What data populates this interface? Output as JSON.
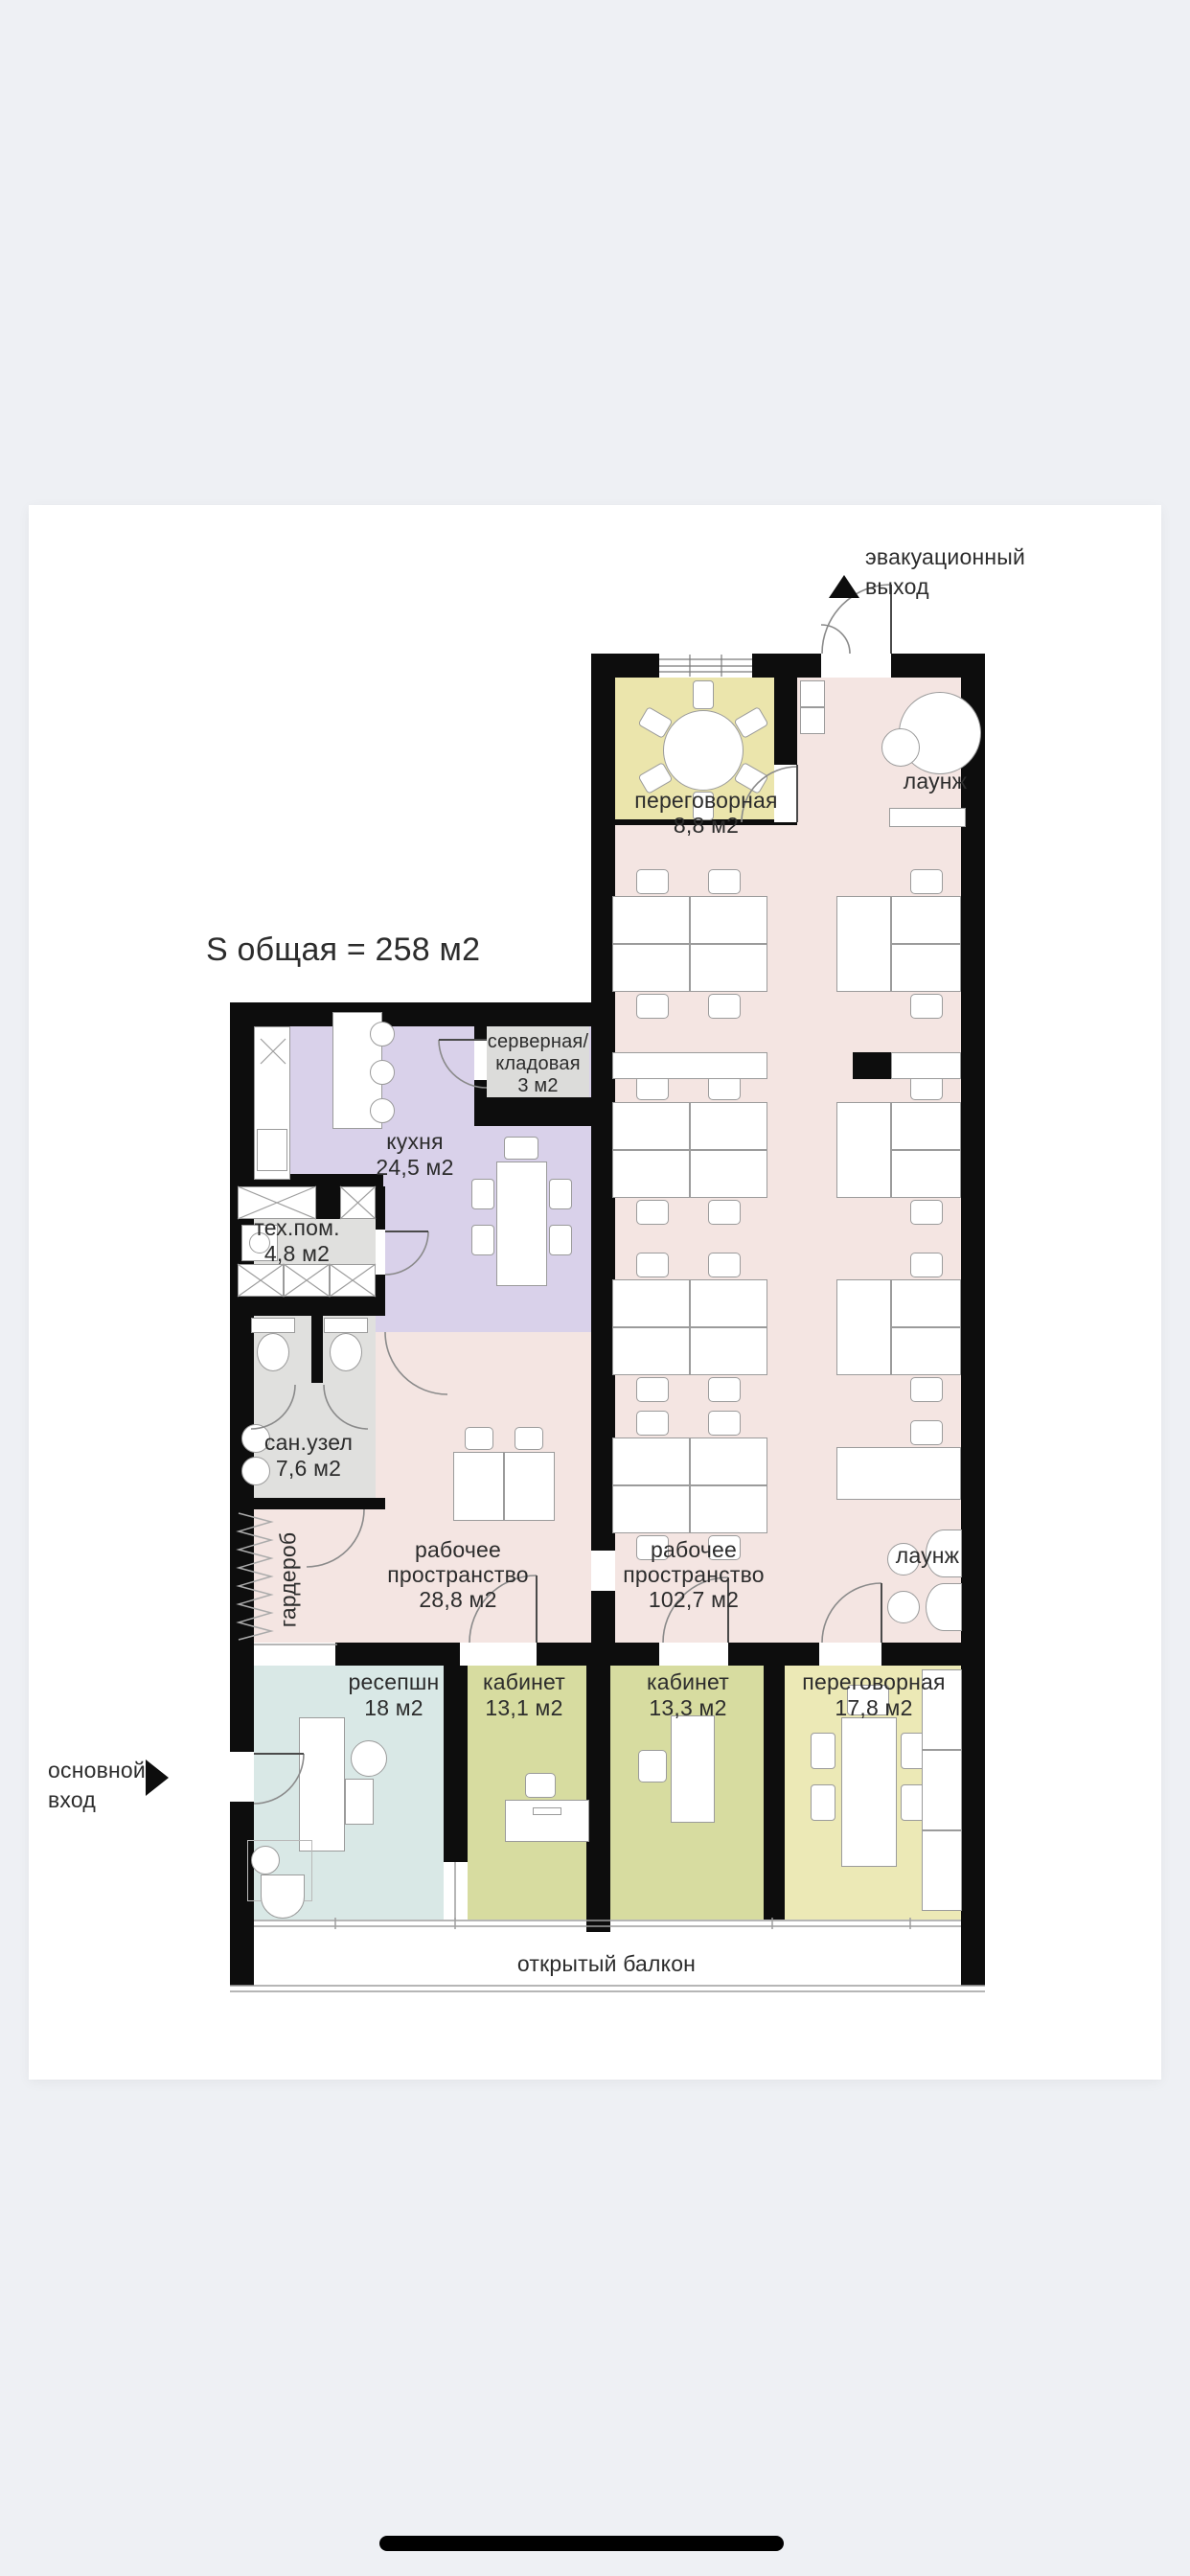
{
  "plan": {
    "total_area_label": "S общая =  258 м2",
    "evacuation_exit": {
      "line1": "эвакуационный",
      "line2": "выход"
    },
    "main_entrance": {
      "line1": "основной",
      "line2": "вход"
    },
    "balcony_label": "открытый балкон",
    "rooms": {
      "meeting_top": {
        "name": "переговорная",
        "area": "8,8 м2"
      },
      "lounge_top": {
        "name": "лаунж"
      },
      "server": {
        "line1": "серверная/",
        "line2": "кладовая",
        "area": "3 м2"
      },
      "kitchen": {
        "name": "кухня",
        "area": "24,5 м2"
      },
      "tech": {
        "name": "тех.пом.",
        "area": "4,8 м2"
      },
      "wc": {
        "name": "сан.узел",
        "area": "7,6 м2"
      },
      "wardrobe": {
        "name": "гардероб"
      },
      "workspace_small": {
        "line1": "рабочее",
        "line2": "пространство",
        "area": "28,8 м2"
      },
      "workspace_large": {
        "line1": "рабочее",
        "line2": "пространство",
        "area": "102,7 м2"
      },
      "lounge_bottom": {
        "name": "лаунж"
      },
      "reception": {
        "name": "ресепшн",
        "area": "18 м2"
      },
      "office1": {
        "name": "кабинет",
        "area": "13,1 м2"
      },
      "office2": {
        "name": "кабинет",
        "area": "13,3 м2"
      },
      "meeting_bottom": {
        "name": "переговорная",
        "area": "17,8 м2"
      }
    }
  },
  "colors": {
    "background": "#eef0f4",
    "wall": "#0d0d0d",
    "open_space": "#f4e5e2",
    "meeting_top": "#ebe5ac",
    "meeting_bottom": "#ece9b6",
    "office": "#d7dca0",
    "reception": "#d9e8e6",
    "kitchen": "#d9d1ea",
    "utility": "#e0e0de",
    "server": "#dcdcda"
  }
}
